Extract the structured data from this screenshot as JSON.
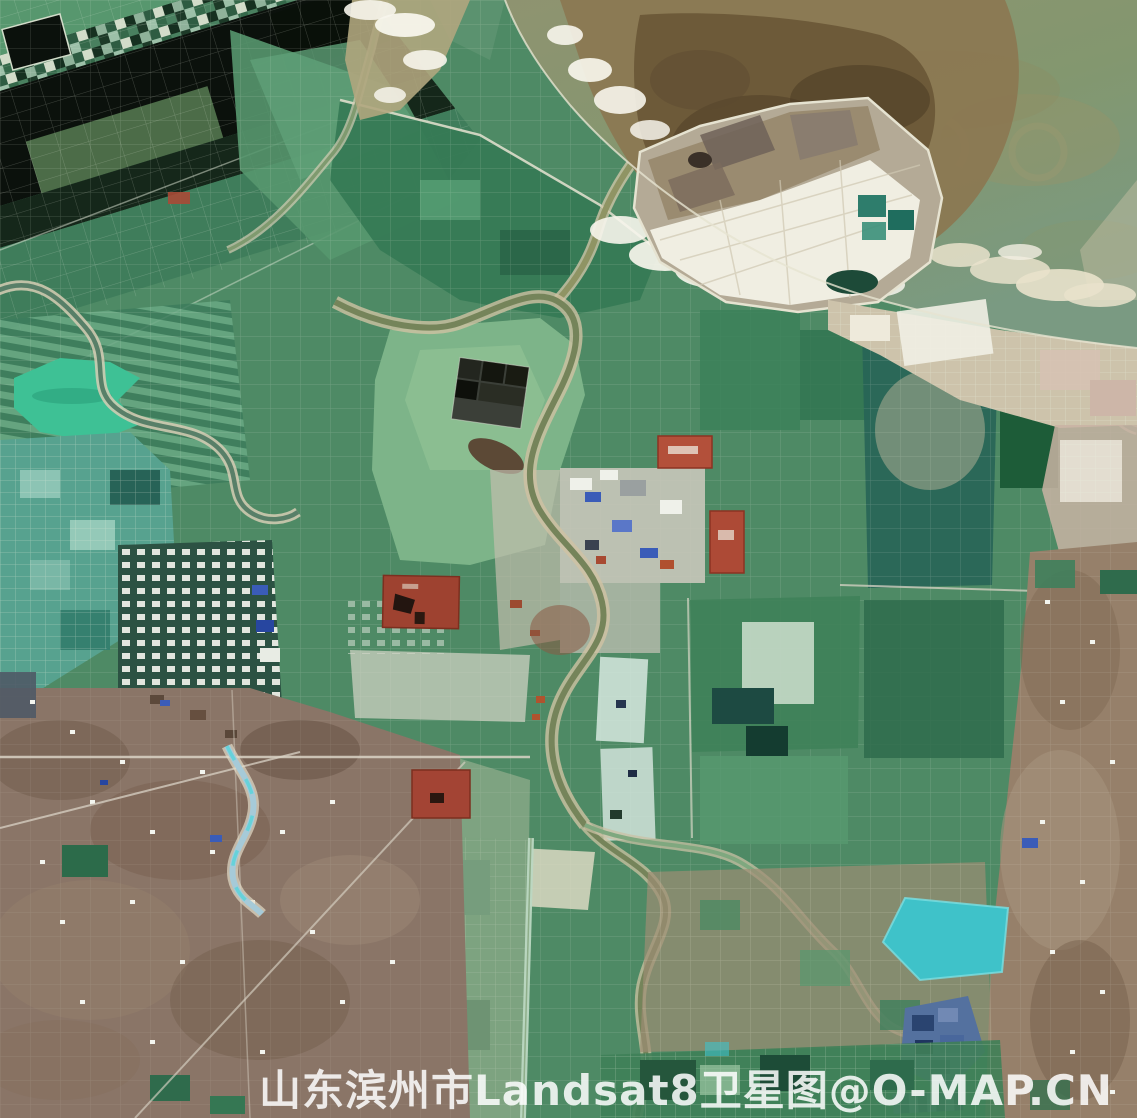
{
  "watermark": {
    "text": "山东滨州市Landsat8卫星图@O-MAP.CN",
    "province": "山东",
    "city": "滨州市",
    "satellite": "Landsat8",
    "label_type": "卫星图",
    "brand": "O-MAP.CN",
    "color": "#ffffff"
  },
  "palette": {
    "land_green": "#4e8a65",
    "field_mid": "#57976e",
    "field_light": "#7db489",
    "field_pale": "#a3c9a6",
    "field_dark": "#2e6b4c",
    "field_deep": "#1d4c37",
    "pond_black": "#0b110c",
    "black_green": "#15271a",
    "lake_turquoise": "#3ec195",
    "teal_pond": "#57a28f",
    "teal_dark": "#276357",
    "sea_olive": "#8e9370",
    "sea_green": "#7a9a81",
    "tidal_brown": "#8b7852",
    "tidal_dark": "#695636",
    "sediment_dark": "#503f28",
    "foam_white": "#f7f5ec",
    "foam_cream": "#e9e2cb",
    "salt_white": "#edeadd",
    "salt_tan": "#cdc3ab",
    "pink_flat": "#c9b3a3",
    "urban_tan": "#8a7567",
    "urban_dark": "#6d5849",
    "urban_light": "#a7947f",
    "red_industrial": "#9e4230",
    "red_bright": "#b3503a",
    "blue_roof": "#3a5cb8",
    "river_olive": "#75845a",
    "river_bank": "#cfc2a2",
    "river_blue": "#a6cad8",
    "cyan_water": "#3fc2c9",
    "blue_pond": "#54719f",
    "blue_pond_dark": "#2a4470",
    "road_light": "#d9d3c5",
    "dike_light": "#e6e3d1",
    "white_spot": "#f3f5ef",
    "watermark_white": "#ffffff"
  }
}
